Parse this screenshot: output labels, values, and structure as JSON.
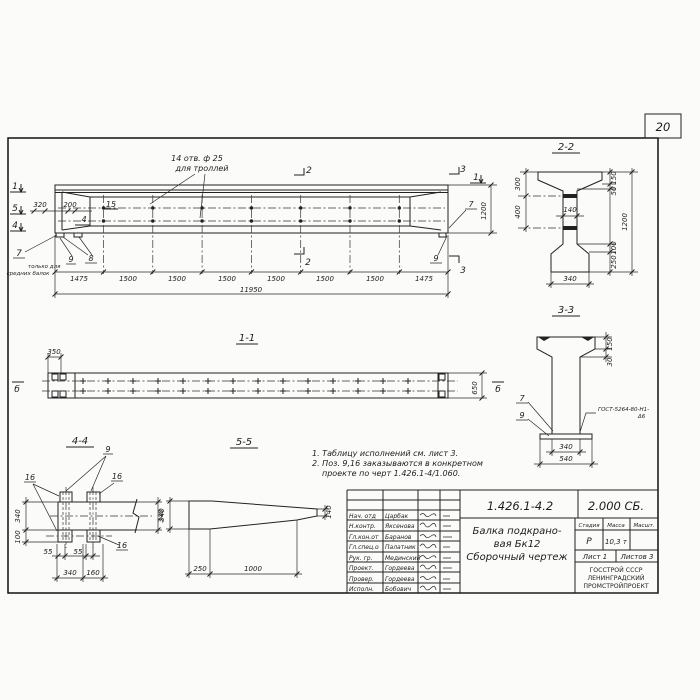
{
  "page_number": "20",
  "elevation": {
    "marker_1": "1",
    "marker_5": "5",
    "marker_4": "4",
    "dim_320": "320",
    "dim_200": "200",
    "pos_15": "15",
    "marker_4_small": "4",
    "holes_note_1": "14 отв. ф 25",
    "holes_note_2": "для троллей",
    "callout_7": "7",
    "note_7_1": "только для",
    "note_7_2": "средних балок",
    "callout_8": "8",
    "callout_9": "9",
    "marker_2": "2",
    "marker_3": "3",
    "marker_1_right": "1",
    "callout_7_right": "7",
    "callout_9_right": "9",
    "dim_1200": "1200",
    "segments": [
      "1475",
      "1500",
      "1500",
      "1500",
      "1500",
      "1500",
      "1500",
      "1475"
    ],
    "dim_total": "11950"
  },
  "section22": {
    "title": "2-2",
    "dim_300": "300",
    "dim_400": "400",
    "dim_140": "140",
    "dim_150": "150",
    "dim_50": "50",
    "dim_1200": "1200",
    "dim_100": "100",
    "dim_250": "250",
    "dim_340": "340"
  },
  "section33": {
    "title": "3-3",
    "dim_150": "150",
    "dim_30": "30",
    "dim_340": "340",
    "dim_540": "540",
    "callout_7": "7",
    "callout_9": "9",
    "weld_1": "ГОСТ-5264-80-Н1-",
    "weld_2": "Δ6"
  },
  "section11": {
    "title": "1-1",
    "dim_350": "350",
    "dim_650": "650",
    "marker_b_left": "б",
    "marker_b_right": "б"
  },
  "section44": {
    "title": "4-4",
    "callout_9": "9",
    "callout_16a": "16",
    "callout_16b": "16",
    "callout_16c": "16",
    "dim_340_left": "340",
    "dim_100": "100",
    "dim_340_right": "340",
    "dim_55a": "55",
    "dim_55b": "55",
    "dim_340_bottom": "340",
    "dim_160": "160"
  },
  "section55": {
    "title": "5-5",
    "dim_340": "340",
    "dim_250": "250",
    "dim_1000": "1000",
    "dim_140": "140"
  },
  "notes": {
    "line1": "1. Таблицу исполнений  см. лист 3.",
    "line2": "2. Поз. 9,16 заказываются в конкретном",
    "line3": "проекте по черт 1.426.1-4/1.060."
  },
  "title_block": {
    "doc_number": "1.426.1-4.2",
    "doc_series": "2.000 СБ.",
    "product_line1": "Балка подкрано-",
    "product_line2": "вая Бк12",
    "product_line3": "Сборочный чертеж",
    "col_stage": "Стадия",
    "col_mass": "Масса",
    "col_scale": "Масшт.",
    "stage": "Р",
    "mass": "10,3 т",
    "scale": "",
    "sheet": "Лист 1",
    "sheets": "Листов 3",
    "org1": "ГОССТРОЙ СССР",
    "org2": "ЛЕНИНГРАДСКИЙ",
    "org3": "ПРОМСТРОЙПРОЕКТ",
    "rows": [
      {
        "role": "Нач. отд",
        "name": "Царбак"
      },
      {
        "role": "Н.контр.",
        "name": "Яксенова"
      },
      {
        "role": "Гл.кон.от",
        "name": "Баранов"
      },
      {
        "role": "Гл.спец.о",
        "name": "Палатник"
      },
      {
        "role": "Рук. гр.",
        "name": "Мединский"
      },
      {
        "role": "Проект.",
        "name": "Гордеева"
      },
      {
        "role": "Провер.",
        "name": "Гордеева"
      },
      {
        "role": "Исполн.",
        "name": "Бобович"
      }
    ]
  }
}
